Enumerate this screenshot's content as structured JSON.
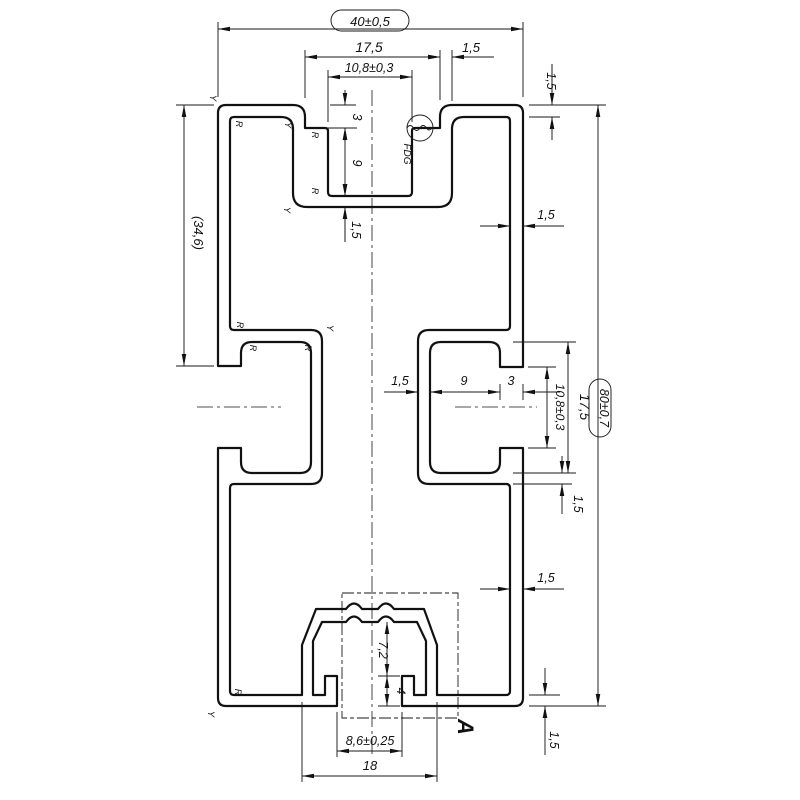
{
  "drawing": {
    "type": "extrusion-profile-cross-section",
    "dimensions": {
      "overall_width": "40±0,5",
      "overall_height": "80±0,7",
      "left_reference_height": "(34,6)",
      "top_slot_opening_width": "17,5",
      "top_slot_wall": "1,5",
      "top_slot_inner_width": "10,8±0,3",
      "top_slot_step_depth": "3",
      "top_slot_inner_depth": "9",
      "top_slot_floor": "1,5",
      "top_wall_thickness": "1,5",
      "right_wall_upper": "1,5",
      "side_slot_wall": "1,5",
      "side_slot_inner_width": "9",
      "side_slot_neck_depth": "3",
      "side_slot_opening_height": "10,8±0,3",
      "side_slot_height": "17,5",
      "side_slot_floor": "1,5",
      "right_wall_lower": "1,5",
      "bottom_wall_thickness": "1,5",
      "channel_depth": "7,2",
      "channel_lip_height": "4",
      "screw_slot_width": "8,6±0,25",
      "channel_width": "18"
    },
    "annotations": {
      "detail_label": "A",
      "surface_mark": "FDG",
      "radius_mark": "R",
      "rounding_mark": "Y"
    },
    "colors": {
      "line": "#111111",
      "background": "#ffffff"
    }
  }
}
